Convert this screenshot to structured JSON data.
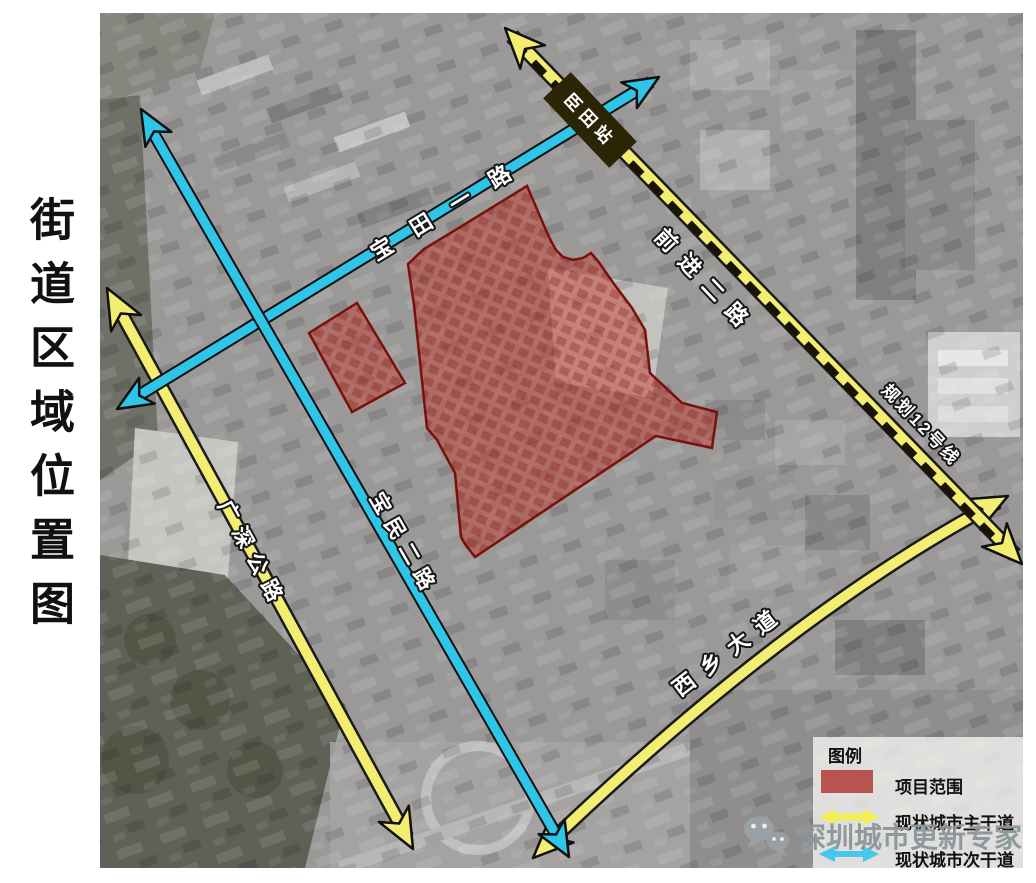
{
  "page": {
    "title": "街道区域位置图"
  },
  "map": {
    "roads": {
      "baotian": {
        "label": "宝田一路",
        "type": "secondary"
      },
      "baomin": {
        "label": "宝民二路",
        "type": "secondary"
      },
      "guangshen": {
        "label": "广深公路",
        "type": "primary"
      },
      "xixiang": {
        "label": "西乡大道",
        "type": "primary"
      },
      "qianjin": {
        "label": "前进二路",
        "type": "primary"
      },
      "metro": {
        "label": "规划12号线",
        "type": "planned-metro"
      }
    },
    "station": {
      "label": "臣田站"
    }
  },
  "legend": {
    "title": "图例",
    "items": [
      {
        "type": "swatch",
        "label": "项目范围"
      },
      {
        "type": "arrow-yellow",
        "label": "现状城市主干道"
      },
      {
        "type": "arrow-blue",
        "label": "现状城市次干道"
      }
    ]
  },
  "watermark": {
    "text": "深圳城市更新专家",
    "icon": "wechat-icon"
  },
  "colors": {
    "road_blue": "#2ec5e8",
    "road_yellow": "#f3ee71",
    "dash": "#181305",
    "station_bar": "#2b2405",
    "project_fill": "#c0392b",
    "project_border": "#7a100c",
    "legend_red": "#b85450",
    "legend_yellow": "#f2ee55",
    "legend_blue": "#45c8ec",
    "watermark": "#8b9599",
    "title": "#111111"
  }
}
